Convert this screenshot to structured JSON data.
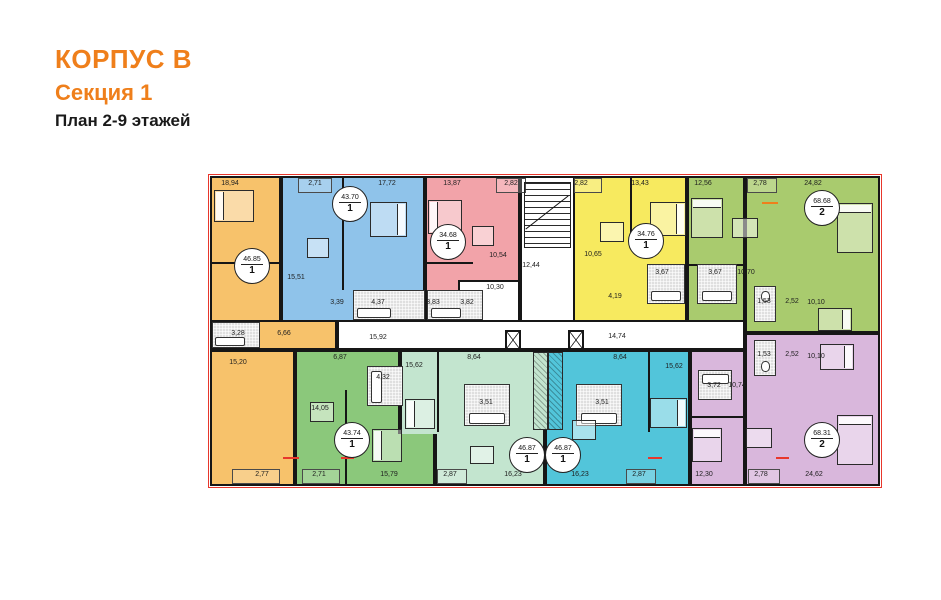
{
  "header": {
    "building": "КОРПУС В",
    "section": "Секция 1",
    "plan_caption": "План 2-9 этажей"
  },
  "colors": {
    "accent": "#EF7F1B",
    "wall": "#161616",
    "outline_red": "#E8372C",
    "bath_gray": "#DFDFDF",
    "white": "#FFFFFF",
    "apartments": {
      "orange": "#F7C26B",
      "blue": "#8FC3EA",
      "pink": "#F2A3A9",
      "yellow": "#F7EA5F",
      "green_top": "#A9CB6E",
      "green_bottom": "#8BC87B",
      "mint": "#C3E5CF",
      "teal": "#52C5DA",
      "purple": "#D9B7DC"
    }
  },
  "plan": {
    "apartments": [
      {
        "name": "orange",
        "badge": {
          "area": "46.85",
          "rooms": "1"
        },
        "rooms": [
          "18,94",
          "3,28",
          "6,66",
          "15,20",
          "2,77"
        ]
      },
      {
        "name": "blue",
        "badge": {
          "area": "43.70",
          "rooms": "1"
        },
        "rooms": [
          "2,71",
          "17,72",
          "15,51",
          "3,39",
          "4,37"
        ]
      },
      {
        "name": "pink",
        "badge": {
          "area": "34.68",
          "rooms": "1"
        },
        "rooms": [
          "13,87",
          "2,82",
          "10,54",
          "3,83",
          "3,82"
        ]
      },
      {
        "name": "yellow",
        "badge": {
          "area": "34.76",
          "rooms": "1"
        },
        "rooms": [
          "2,82",
          "13,43",
          "10,65",
          "4,19",
          "3,67"
        ]
      },
      {
        "name": "green_top",
        "badge": {
          "area": "68.68",
          "rooms": "2"
        },
        "rooms": [
          "12,56",
          "2,78",
          "24,82",
          "3,67",
          "10,70",
          "1,53",
          "2,52",
          "10,10"
        ]
      },
      {
        "name": "green_bottom",
        "badge": {
          "area": "43.74",
          "rooms": "1"
        },
        "rooms": [
          "6,87",
          "4,32",
          "14,05",
          "2,71",
          "15,79"
        ]
      },
      {
        "name": "mint",
        "badge": {
          "area": "46.87",
          "rooms": "1"
        },
        "rooms": [
          "15,62",
          "8,64",
          "3,51",
          "2,87",
          "16,23"
        ]
      },
      {
        "name": "teal",
        "badge": {
          "area": "46.87",
          "rooms": "1"
        },
        "rooms": [
          "8,64",
          "3,51",
          "16,23",
          "15,62",
          "2,87"
        ]
      },
      {
        "name": "purple",
        "badge": {
          "area": "68.31",
          "rooms": "2"
        },
        "rooms": [
          "1,53",
          "2,52",
          "10,10",
          "3,72",
          "10,74",
          "12,30",
          "2,78",
          "24,62"
        ]
      }
    ],
    "common": {
      "stairwell": "12,44",
      "entry_hall": "10,30",
      "corridor_left": "15,92",
      "corridor_right": "14,74"
    }
  },
  "icons": {
    "stairs": "stairs-icon",
    "elevator": "elevator-icon",
    "bed": "bed-icon",
    "dining_table": "dining-table-icon",
    "bathtub": "bathtub-icon",
    "wardrobe": "wardrobe-icon"
  }
}
